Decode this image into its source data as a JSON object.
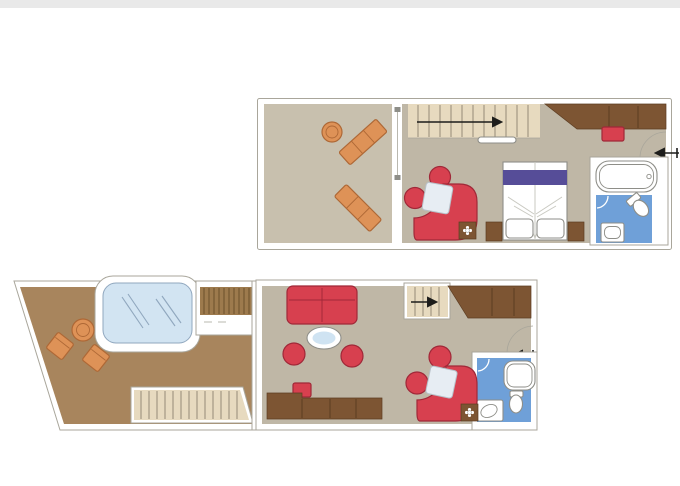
{
  "colors": {
    "page_bg": "#ffffff",
    "top_band": "#e9e9e9",
    "wall_white": "#ffffff",
    "outline_grey": "#a9a69b",
    "floor_balcony": "#c8c0ae",
    "floor_cabin": "#bfb7a6",
    "floor_terrace": "#a8855d",
    "stair_light": "#e7dabf",
    "stair_line": "#968b77",
    "deck_wood": "#9d7a4d",
    "deck_wood_line": "#6f5430",
    "wood_dark": "#7d5533",
    "wood_seam": "#5c3d22",
    "orange": "#de9257",
    "orange_dark": "#ae6836",
    "red": "#d7404f",
    "red_dark": "#a02838",
    "purple": "#564d98",
    "bath_blue": "#6fa0d8",
    "tub_blue": "#d2e4f2",
    "tub_blue_line": "#90a7be",
    "fixture_white": "#ffffff",
    "fixture_outline": "#8e8e88",
    "table_white": "#e7edf3",
    "table_outline": "#b7c1c9",
    "table_blue": "#cfe3f2",
    "bed_fold": "#c9c9c1",
    "arrow_black": "#1d1d1b"
  },
  "floorplan": {
    "type": "two-level suite floor plan",
    "levels": [
      {
        "id": "upper",
        "areas": [
          {
            "name": "sun-deck-balcony",
            "items": [
              "round-side-table",
              "sun-lounger",
              "sun-lounger"
            ],
            "door": "sliding-door"
          },
          {
            "name": "bedroom",
            "items": [
              "staircase-up",
              "direction-arrow",
              "wardrobe",
              "ottoman",
              "armchair",
              "armchair",
              "curved-sofa",
              "corner-table",
              "side-table-with-flower",
              "double-bed",
              "purple-bed-runner",
              "pillow",
              "pillow",
              "nightstand",
              "nightstand"
            ],
            "door": "entry-door-with-arrow"
          },
          {
            "name": "bathroom",
            "items": [
              "bathtub",
              "toilet",
              "washbasin"
            ]
          }
        ]
      },
      {
        "id": "lower",
        "areas": [
          {
            "name": "private-terrace",
            "items": [
              "hot-tub",
              "deck-steps",
              "round-table",
              "outdoor-chair",
              "outdoor-chair",
              "terrace-staircase"
            ]
          },
          {
            "name": "living-room",
            "items": [
              "sofa",
              "oval-coffee-table",
              "tub-chair",
              "tub-chair",
              "stool",
              "desk",
              "staircase-up",
              "direction-arrow",
              "wardrobe",
              "armchair",
              "armchair",
              "curved-sofa",
              "corner-table",
              "side-table-with-flower"
            ],
            "door": "entry-door-with-arrow"
          },
          {
            "name": "bathroom",
            "items": [
              "shower",
              "toilet",
              "washbasin"
            ]
          }
        ]
      }
    ]
  }
}
